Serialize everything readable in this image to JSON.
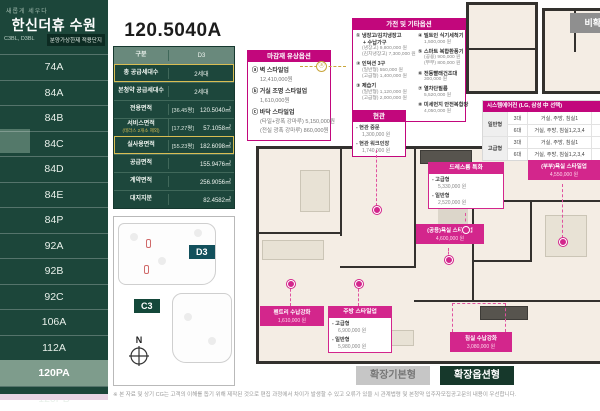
{
  "sidebar": {
    "tagline": "새롭게 세우다",
    "title": "한신더휴 수원",
    "blocks": "C3BL, D3BL",
    "badge": "분양가상한제 적용단지",
    "items": [
      {
        "label": "74A",
        "selected": false
      },
      {
        "label": "84A",
        "selected": false
      },
      {
        "label": "84B",
        "selected": false
      },
      {
        "label": "84C",
        "selected": false
      },
      {
        "label": "84D",
        "selected": false
      },
      {
        "label": "84E",
        "selected": false
      },
      {
        "label": "84P",
        "selected": false
      },
      {
        "label": "92A",
        "selected": false
      },
      {
        "label": "92B",
        "selected": false
      },
      {
        "label": "92C",
        "selected": false
      },
      {
        "label": "106A",
        "selected": false
      },
      {
        "label": "112A",
        "selected": false
      },
      {
        "label": "120PA",
        "selected": true
      },
      {
        "label": "120PB",
        "selected": false
      }
    ]
  },
  "unit": {
    "title": "120.5040A",
    "table": {
      "rows": [
        {
          "label": "구분",
          "value": "D3"
        },
        {
          "label": "총 공급세대수",
          "value": "2세대"
        },
        {
          "label": "본청약 공급세대수",
          "value": "2세대"
        },
        {
          "label": "전용면적",
          "pyeong": "[36.45평]",
          "value": "120.5040㎡"
        },
        {
          "label": "서비스면적",
          "sub": "(테라스 2개소 제외)",
          "pyeong": "[17.27평]",
          "value": "57.1058㎡"
        },
        {
          "label": "실사용면적",
          "pyeong": "[55.23평]",
          "value": "182.6098㎡"
        },
        {
          "label": "공급면적",
          "value": "155.9476㎡"
        },
        {
          "label": "계약면적",
          "value": "256.9056㎡"
        },
        {
          "label": "대지지분",
          "value": "82.4582㎡"
        }
      ]
    }
  },
  "site_plan": {
    "d3": "D3",
    "c3": "C3",
    "compass": "N"
  },
  "finish_options": {
    "title": "마감재 유상옵션",
    "items": [
      {
        "marker": "ⓐ",
        "name": "벽 스타일업",
        "price": "12,410,000원"
      },
      {
        "marker": "ⓑ",
        "name": "거실 조명 스타일업",
        "price": "1,610,000원"
      },
      {
        "marker": "ⓒ",
        "name": "바닥 스타일업",
        "price": "(타일+광폭 강마루) 5,150,000원",
        "price2": "(전실 광폭 강마루) 860,000원"
      }
    ]
  },
  "appliance_options": {
    "title": "가전 및 기타옵션",
    "left": [
      {
        "no": "①",
        "name": "냉장고/김치냉장고",
        "name2": "+ 수납가구",
        "lines": [
          "(냉장고) 9,800,000 원",
          "(김치냉장고) 7,300,000 원"
        ]
      },
      {
        "no": "②",
        "name": "인덕션 3구",
        "lines": [
          "(일반형) 550,000 원",
          "(고급형) 1,400,000 원"
        ]
      },
      {
        "no": "③",
        "name": "제습기",
        "lines": [
          "(일반형) 1,120,000 원",
          "(고급형) 2,000,000 원"
        ]
      }
    ],
    "right": [
      {
        "no": "④",
        "name": "빌트인 식기세척기",
        "lines": [
          "1,500,000 원"
        ]
      },
      {
        "no": "⑤",
        "name": "스마트 복합환풍기",
        "lines": [
          "(공용) 900,000 원",
          "(부부) 800,000 원"
        ]
      },
      {
        "no": "⑥",
        "name": "전동빨래건조대",
        "lines": [
          "300,000 원"
        ]
      },
      {
        "no": "⑦",
        "name": "열차단필름",
        "lines": [
          "5,520,000 원"
        ]
      },
      {
        "no": "⑧",
        "name": "미세먼지 안전복합창",
        "lines": [
          "4,050,000 원"
        ]
      }
    ]
  },
  "entrance_options": {
    "title": "현관",
    "items": [
      {
        "name": "- 현관 중문",
        "price": "1,300,000 원"
      },
      {
        "name": "- 현관 워크인장",
        "price": "1,740,000 원"
      }
    ]
  },
  "aircon_table": {
    "title": "시스템에어컨 (LG, 삼성 中 선택)",
    "rows": [
      {
        "group": "일반형",
        "count": "3대",
        "rooms": "거실, 주방, 침실1",
        "price": "8"
      },
      {
        "group": "",
        "count": "6대",
        "rooms": "거실, 주방, 침실1,2,3,4",
        "price": "9"
      },
      {
        "group": "고급형",
        "count": "3대",
        "rooms": "거실, 주방, 침실1",
        "price": "9"
      },
      {
        "group": "",
        "count": "6대",
        "rooms": "거실, 주방, 침실1,2,3,4",
        "price": "1"
      }
    ]
  },
  "plan_labels": {
    "dressroom": {
      "title": "드레스룸 특화",
      "items": [
        {
          "name": "- 고급형",
          "price": "5,330,000 원"
        },
        {
          "name": "- 일반형",
          "price": "2,520,000 원"
        }
      ]
    },
    "bath_common": {
      "name": "(공용)욕실 스타일업",
      "price": "4,600,000 원"
    },
    "bath_master": {
      "name": "(부부)욕실 스타일업",
      "price": "4,550,000 원"
    },
    "pantry": {
      "name": "펜트리 수납강화",
      "price": "1,610,000 원"
    },
    "kitchen": {
      "title": "주방 스타일업",
      "items": [
        {
          "name": "- 고급형",
          "price": "6,900,000 원"
        },
        {
          "name": "- 일반형",
          "price": "5,980,000 원"
        }
      ]
    },
    "bedroom": {
      "name": "침실 수납강화",
      "price": "3,080,000 원"
    }
  },
  "buttons": {
    "expand_basic": "확장기본형",
    "expand_option": "확장옵션형",
    "non_expand": "비확장형"
  },
  "disclaimer": "※ 본 자료 및 상기 CG는 고객의 이해를 돕기 위해 제작된 것으로 편집 과정에서 차이가 발생할 수 있고 오류가 있을 시 관계법령 및 본청약 입주자모집공고문의 내용이 우선합니다.",
  "colors": {
    "accent_green": "#1c463a",
    "accent_magenta": "#c2077c",
    "highlight_gold": "#d9bd53"
  }
}
